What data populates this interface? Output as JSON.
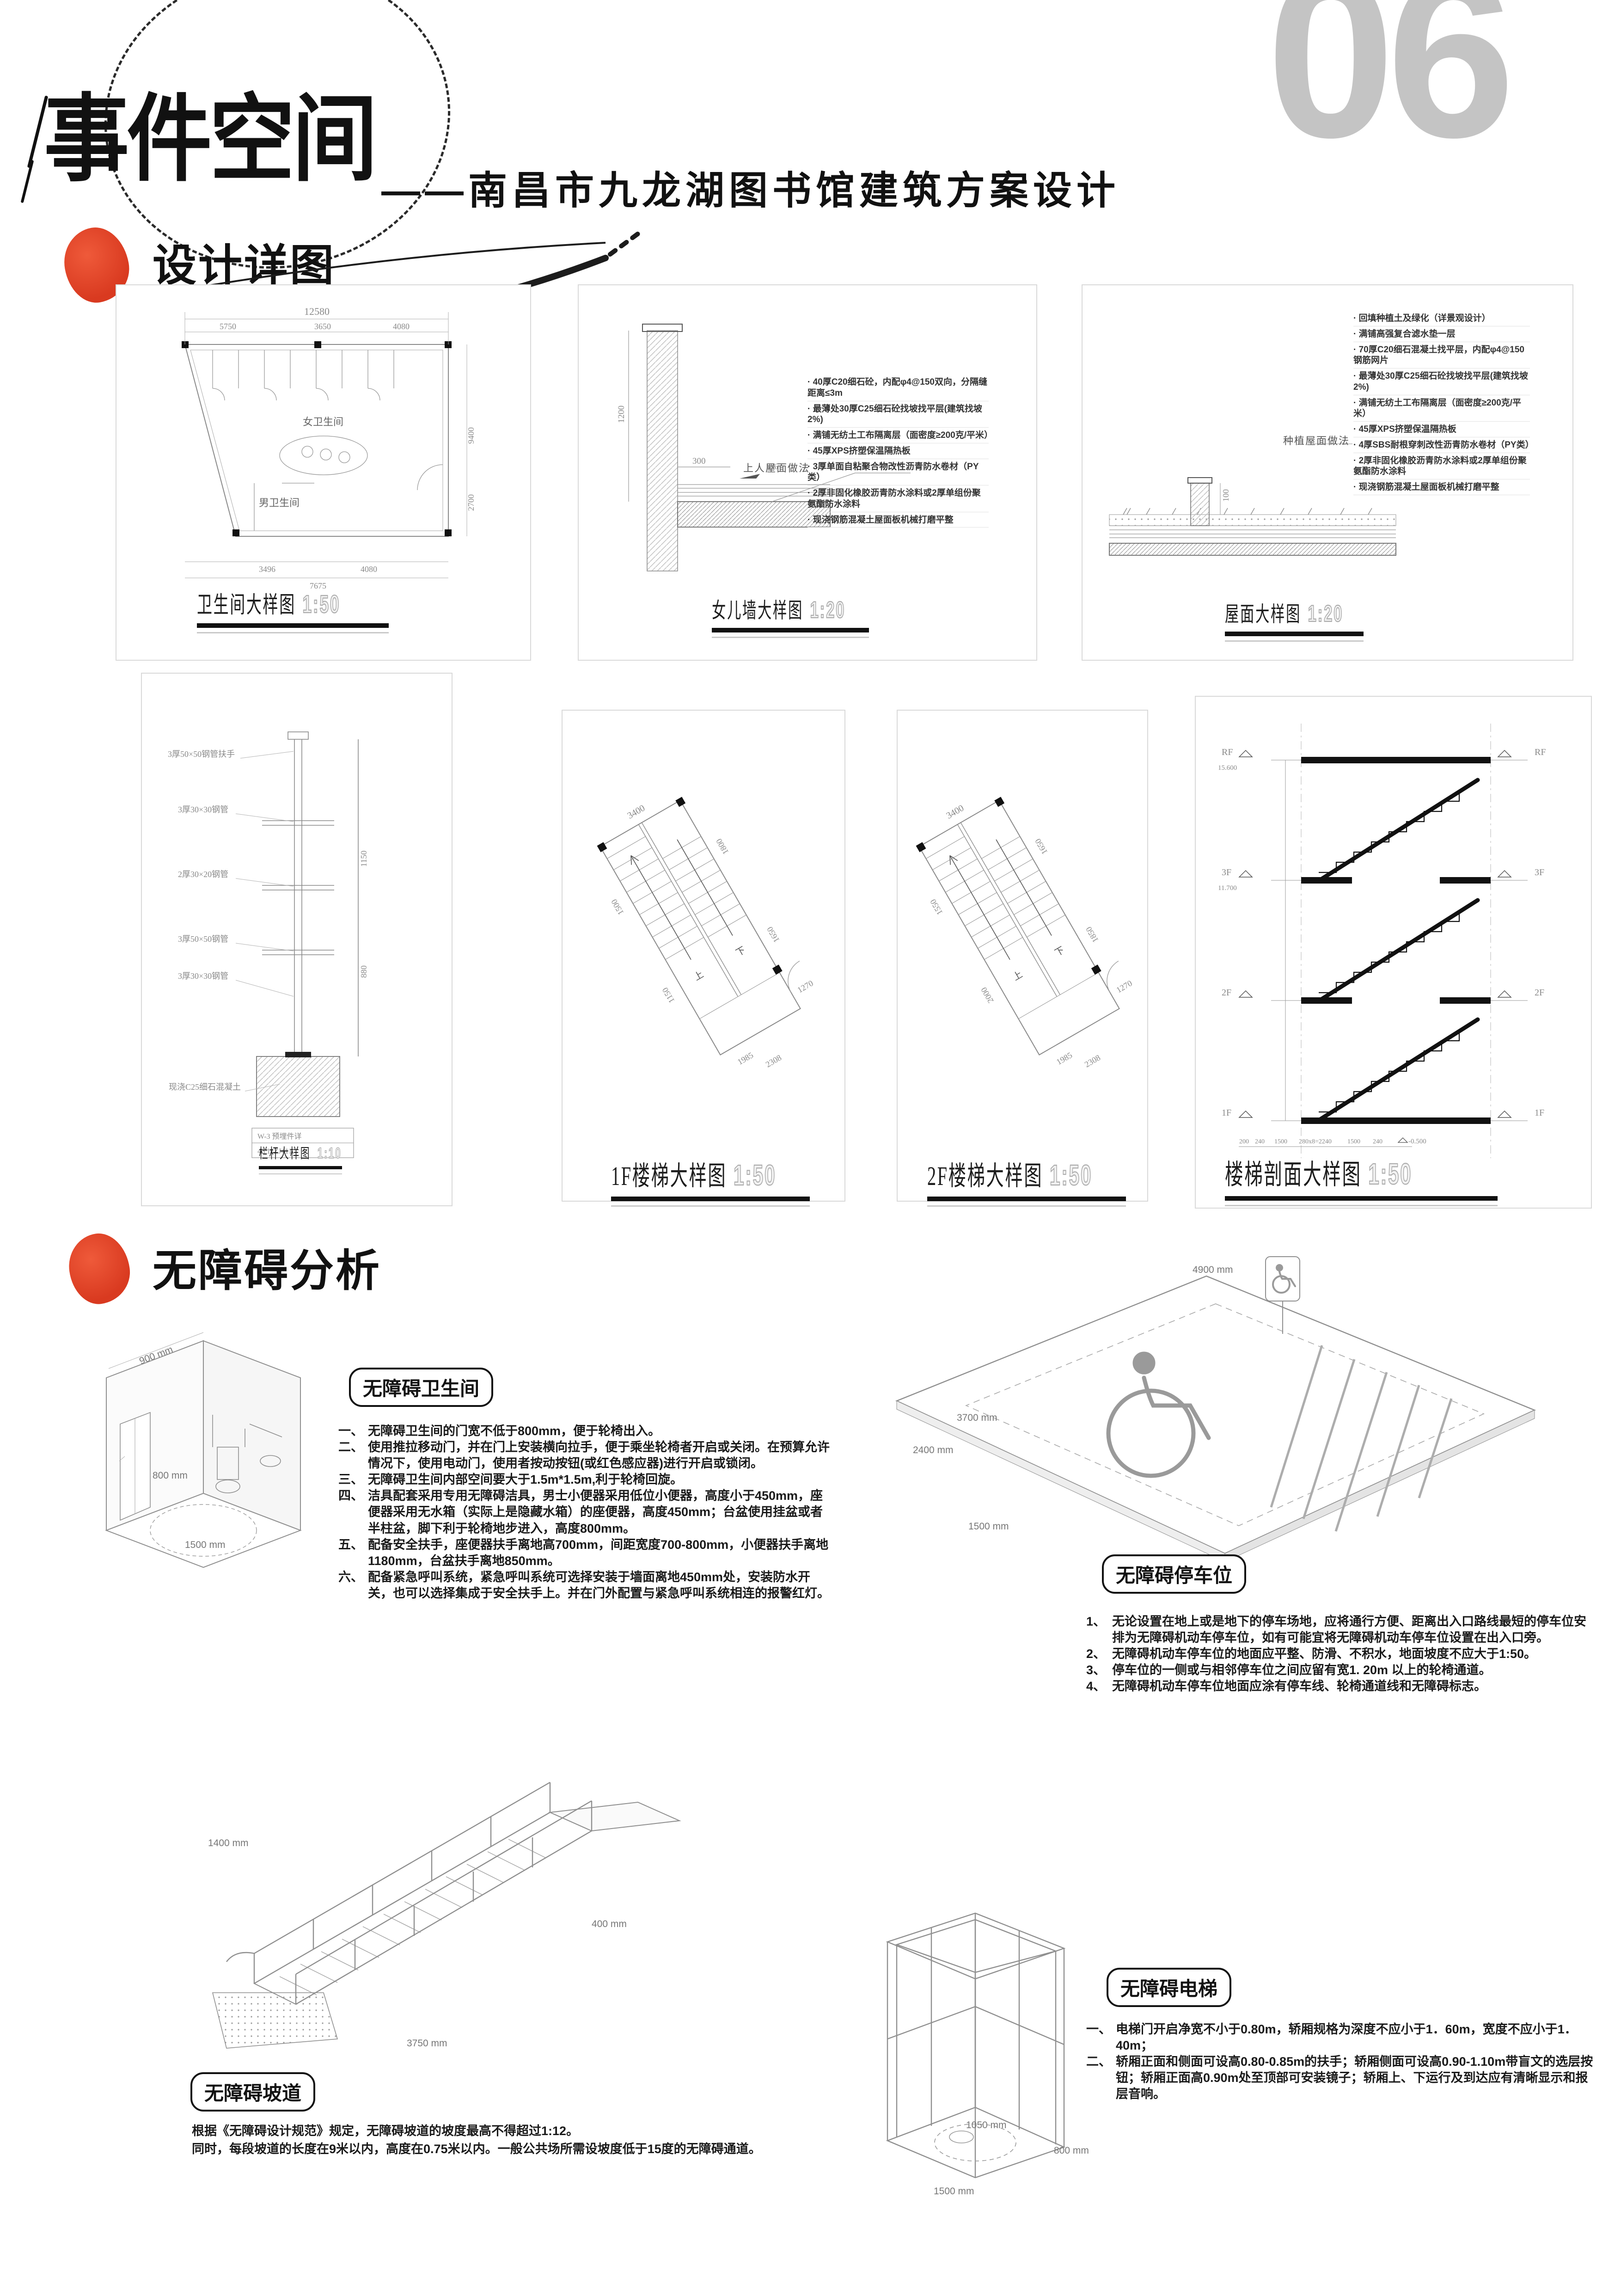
{
  "header": {
    "page_number": "06",
    "title": "事件空间",
    "subtitle": "——南昌市九龙湖图书馆建筑方案设计",
    "section_details": "设计详图",
    "section_accessibility": "无障碍分析"
  },
  "drawings": {
    "toilet": {
      "title": "卫生间大样图",
      "scale": "1:50",
      "rooms": {
        "female": "女卫生间",
        "male": "男卫生间"
      },
      "dims": [
        "12580",
        "5750",
        "3650",
        "4080",
        "9400",
        "2700",
        "3496",
        "4080",
        "7675"
      ]
    },
    "parapet": {
      "title": "女儿墙大样图",
      "scale": "1:20",
      "callout": "上人屋面做法",
      "dims": [
        "1200",
        "300",
        "2%"
      ],
      "notes": [
        "· 40厚C20细石砼，内配φ4@150双向，分隔缝距离≤3m",
        "· 最薄处30厚C25细石砼找坡找平层(建筑找坡2%)",
        "· 满铺无纺土工布隔离层（面密度≥200克/平米）",
        "· 45厚XPS挤塑保温隔热板",
        "· 3厚单面自粘聚合物改性沥青防水卷材（PY类）",
        "· 2厚非固化橡胶沥青防水涂料或2厚单组份聚氨酯防水涂料",
        "· 现浇钢筋混凝土屋面板机械打磨平整"
      ]
    },
    "roof": {
      "title": "屋面大样图",
      "scale": "1:20",
      "callout": "种植屋面做法",
      "dims": [
        "100"
      ],
      "notes": [
        "· 回填种植土及绿化（详景观设计）",
        "· 满铺高强复合滤水垫一层",
        "· 70厚C20细石混凝土找平层，内配φ4@150钢筋网片",
        "· 最薄处30厚C25细石砼找坡找平层(建筑找坡2%)",
        "· 满铺无纺土工布隔离层（面密度≥200克/平米）",
        "· 45厚XPS挤塑保温隔热板",
        "· 4厚SBS耐根穿刺改性沥青防水卷材（PY类）",
        "· 2厚非固化橡胶沥青防水涂料或2厚单组份聚氨酯防水涂料",
        "· 现浇钢筋混凝土屋面板机械打磨平整"
      ]
    },
    "railing": {
      "title": "栏杆大样图",
      "scale": "1:10",
      "annotations": [
        "3厚50×50钢管扶手",
        "3厚30×30钢管",
        "2厚30×20钢管",
        "3厚50×50钢管",
        "3厚30×30钢管",
        "现浇C25细石混凝土"
      ],
      "dims": [
        "1150",
        "880"
      ],
      "table": [
        "W-3 预埋件详",
        "46  11ZJ411"
      ]
    },
    "stair1f": {
      "title": "1F楼梯大样图",
      "scale": "1:50",
      "up": "上",
      "down": "下",
      "dims": [
        "3400",
        "1500",
        "1150",
        "1800",
        "1650",
        "1985",
        "2308",
        "1270"
      ]
    },
    "stair2f": {
      "title": "2F楼梯大样图",
      "scale": "1:50",
      "up": "上",
      "down": "下",
      "dims": [
        "3400",
        "1550",
        "2000",
        "1650",
        "1850",
        "1985",
        "2308",
        "1270"
      ]
    },
    "stair_section": {
      "title": "楼梯剖面大样图",
      "scale": "1:50",
      "levels": [
        {
          "name": "RF",
          "elev": "15.600"
        },
        {
          "name": "3F",
          "elev": "11.700"
        },
        {
          "name": "2F",
          "elev": ""
        },
        {
          "name": "1F",
          "elev": ""
        }
      ],
      "bottom_elev": "-0.500",
      "dims": [
        "200",
        "240",
        "1500",
        "280x8=2240",
        "1500",
        "240"
      ]
    }
  },
  "acc": {
    "toilet": {
      "badge": "无障碍卫生间",
      "dims": [
        "900 mm",
        "800 mm",
        "1500 mm"
      ],
      "items": [
        {
          "n": "一、",
          "t": "无障碍卫生间的门宽不低于800mm，便于轮椅出入。"
        },
        {
          "n": "二、",
          "t": "使用推拉移动门，并在门上安装横向拉手，便于乘坐轮椅者开启或关闭。在预算允许情况下，使用电动门，使用者按动按钮(或红色感应器)进行开启或锁闭。"
        },
        {
          "n": "三、",
          "t": "无障碍卫生间内部空间要大于1.5m*1.5m,利于轮椅回旋。"
        },
        {
          "n": "四、",
          "t": "洁具配套采用专用无障碍洁具，男士小便器采用低位小便器，高度小于450mm，座便器采用无水箱（实际上是隐藏水箱）的座便器，高度450mm；台盆使用挂盆或者半柱盆，脚下利于轮椅地步进入，高度800mm。"
        },
        {
          "n": "五、",
          "t": "配备安全扶手，座便器扶手离地高700mm，间距宽度700-800mm，小便器扶手离地1180mm，台盆扶手离地850mm。"
        },
        {
          "n": "六、",
          "t": "配备紧急呼叫系统，紧急呼叫系统可选择安装于墙面离地450mm处，安装防水开关，也可以选择集成于安全扶手上。并在门外配置与紧急呼叫系统相连的报警红灯。"
        }
      ]
    },
    "parking": {
      "badge": "无障碍停车位",
      "dims": [
        "4900 mm",
        "3700 mm",
        "2400 mm",
        "1500 mm"
      ],
      "items": [
        {
          "n": "1、",
          "t": "无论设置在地上或是地下的停车场地，应将通行方便、距离出入口路线最短的停车位安排为无障碍机动车停车位，如有可能宜将无障碍机动车停车位设置在出入口旁。"
        },
        {
          "n": "2、",
          "t": "无障碍机动车停车位的地面应平整、防滑、不积水，地面坡度不应大于1:50。"
        },
        {
          "n": "3、",
          "t": "停车位的一侧或与相邻停车位之间应留有宽1. 20m 以上的轮椅通道。"
        },
        {
          "n": "4、",
          "t": "无障碍机动车停车位地面应涂有停车线、轮椅通道线和无障碍标志。"
        }
      ]
    },
    "ramp": {
      "badge": "无障碍坡道",
      "dims": [
        "1400 mm",
        "400 mm",
        "3750 mm"
      ],
      "lines": [
        "根据《无障碍设计规范》规定，无障碍坡道的坡度最高不得超过1:12。",
        "同时，每段坡道的长度在9米以内，高度在0.75米以内。一般公共场所需设坡度低于15度的无障碍通道。"
      ]
    },
    "elevator": {
      "badge": "无障碍电梯",
      "dims": [
        "1050 mm",
        "800 mm",
        "1500 mm"
      ],
      "items": [
        {
          "n": "一、",
          "t": "电梯门开启净宽不小于0.80m，轿厢规格为深度不应小于1．60m，宽度不应小于1．40m；"
        },
        {
          "n": "二、",
          "t": "轿厢正面和侧面可设高0.80-0.85m的扶手；轿厢侧面可设高0.90-1.10m带盲文的选层按钮；轿厢正面高0.90m处至顶部可安装镜子；轿厢上、下运行及到达应有清晰显示和报层音响。"
        }
      ]
    }
  }
}
